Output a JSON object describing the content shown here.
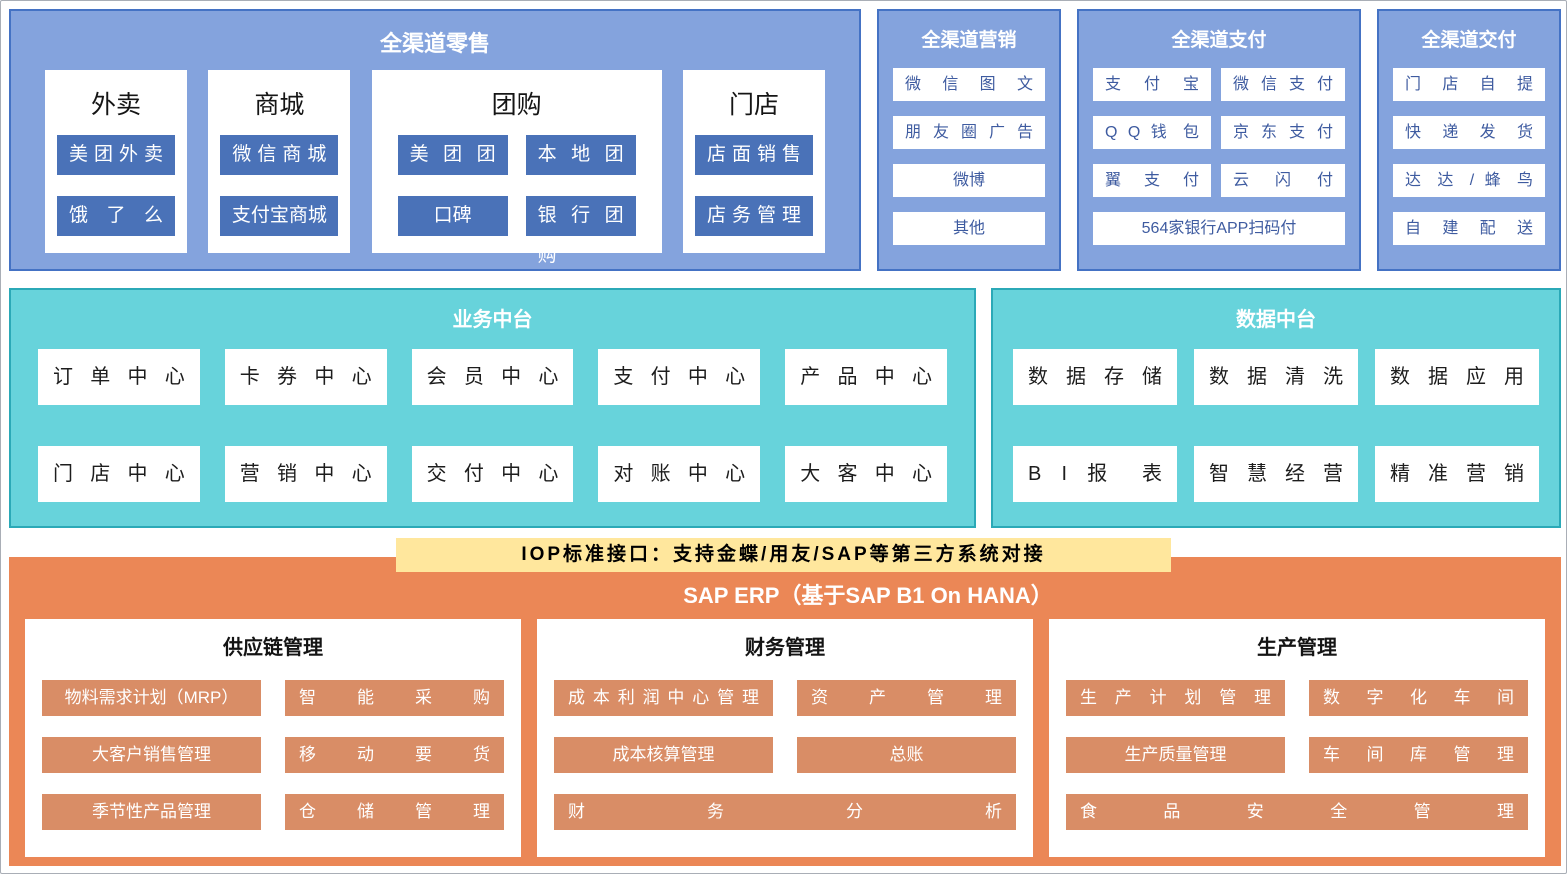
{
  "colors": {
    "panel_blue_bg": "#84A3DD",
    "panel_blue_border": "#4472C4",
    "chip_dark_blue": "#4A72B8",
    "chip_text_navy": "#3E5BA0",
    "teal_bg": "#67D3DB",
    "teal_border": "#2BA9B7",
    "orange_bg": "#EB8756",
    "orange_chip": "#D98D66",
    "banner_yellow": "#FFE79D"
  },
  "retail": {
    "title": "全渠道零售",
    "sections": [
      {
        "title": "外卖",
        "chips": [
          "美 团 外 卖",
          "饿 了 么"
        ]
      },
      {
        "title": "商城",
        "chips": [
          "微 信 商 城",
          "支付宝商城"
        ]
      },
      {
        "title": "团购",
        "chips": [
          "美 团 团 购",
          "本 地 团 购",
          "口碑",
          "银 行 团 购"
        ]
      },
      {
        "title": "门店",
        "chips": [
          "店 面 销 售",
          "店 务 管 理"
        ]
      }
    ]
  },
  "marketing": {
    "title": "全渠道营销",
    "chips": [
      "微 信 图 文",
      "朋 友 圈 广 告",
      "微博",
      "其他"
    ]
  },
  "payment": {
    "title": "全渠道支付",
    "left": [
      "支 付 宝",
      "Q Q 钱 包",
      "翼 支 付"
    ],
    "right": [
      "微 信 支 付",
      "京 东 支 付",
      "云 闪 付"
    ],
    "full": "564家银行APP扫码付"
  },
  "delivery": {
    "title": "全渠道交付",
    "chips": [
      "门 店 自 提",
      "快 递 发 货",
      "达 达 / 蜂 鸟",
      "自 建 配 送"
    ]
  },
  "business": {
    "title": "业务中台",
    "row1": [
      "订 单 中 心",
      "卡 券 中 心",
      "会 员 中 心",
      "支 付 中 心",
      "产 品 中 心"
    ],
    "row2": [
      "门 店 中 心",
      "营 销 中 心",
      "交 付 中 心",
      "对 账 中 心",
      "大 客 中 心"
    ]
  },
  "data_platform": {
    "title": "数据中台",
    "row1": [
      "数 据 存 储",
      "数 据 清 洗",
      "数 据 应 用"
    ],
    "row2": [
      "B I 报 表",
      "智 慧 经 营",
      "精 准 营 销"
    ]
  },
  "iop_banner": "IOP标准接口：支持金蝶/用友/SAP等第三方系统对接",
  "erp": {
    "title": "SAP ERP（基于SAP B1 On HANA）",
    "modules": [
      {
        "title": "供应链管理",
        "rows": [
          [
            "物料需求计划（MRP）",
            "智 能 采 购"
          ],
          [
            "大客户销售管理",
            "移 动 要 货"
          ],
          [
            "季节性产品管理",
            "仓 储 管 理"
          ]
        ]
      },
      {
        "title": "财务管理",
        "rows": [
          [
            "成 本 利 润 中 心 管 理",
            "资 产 管 理"
          ],
          [
            "成本核算管理",
            "总账"
          ]
        ],
        "full": "财 务 分 析"
      },
      {
        "title": "生产管理",
        "rows": [
          [
            "生 产 计 划 管 理",
            "数 字 化 车 间"
          ],
          [
            "生产质量管理",
            "车 间 库 管 理"
          ]
        ],
        "full": "食 品 安 全 管 理"
      }
    ]
  }
}
